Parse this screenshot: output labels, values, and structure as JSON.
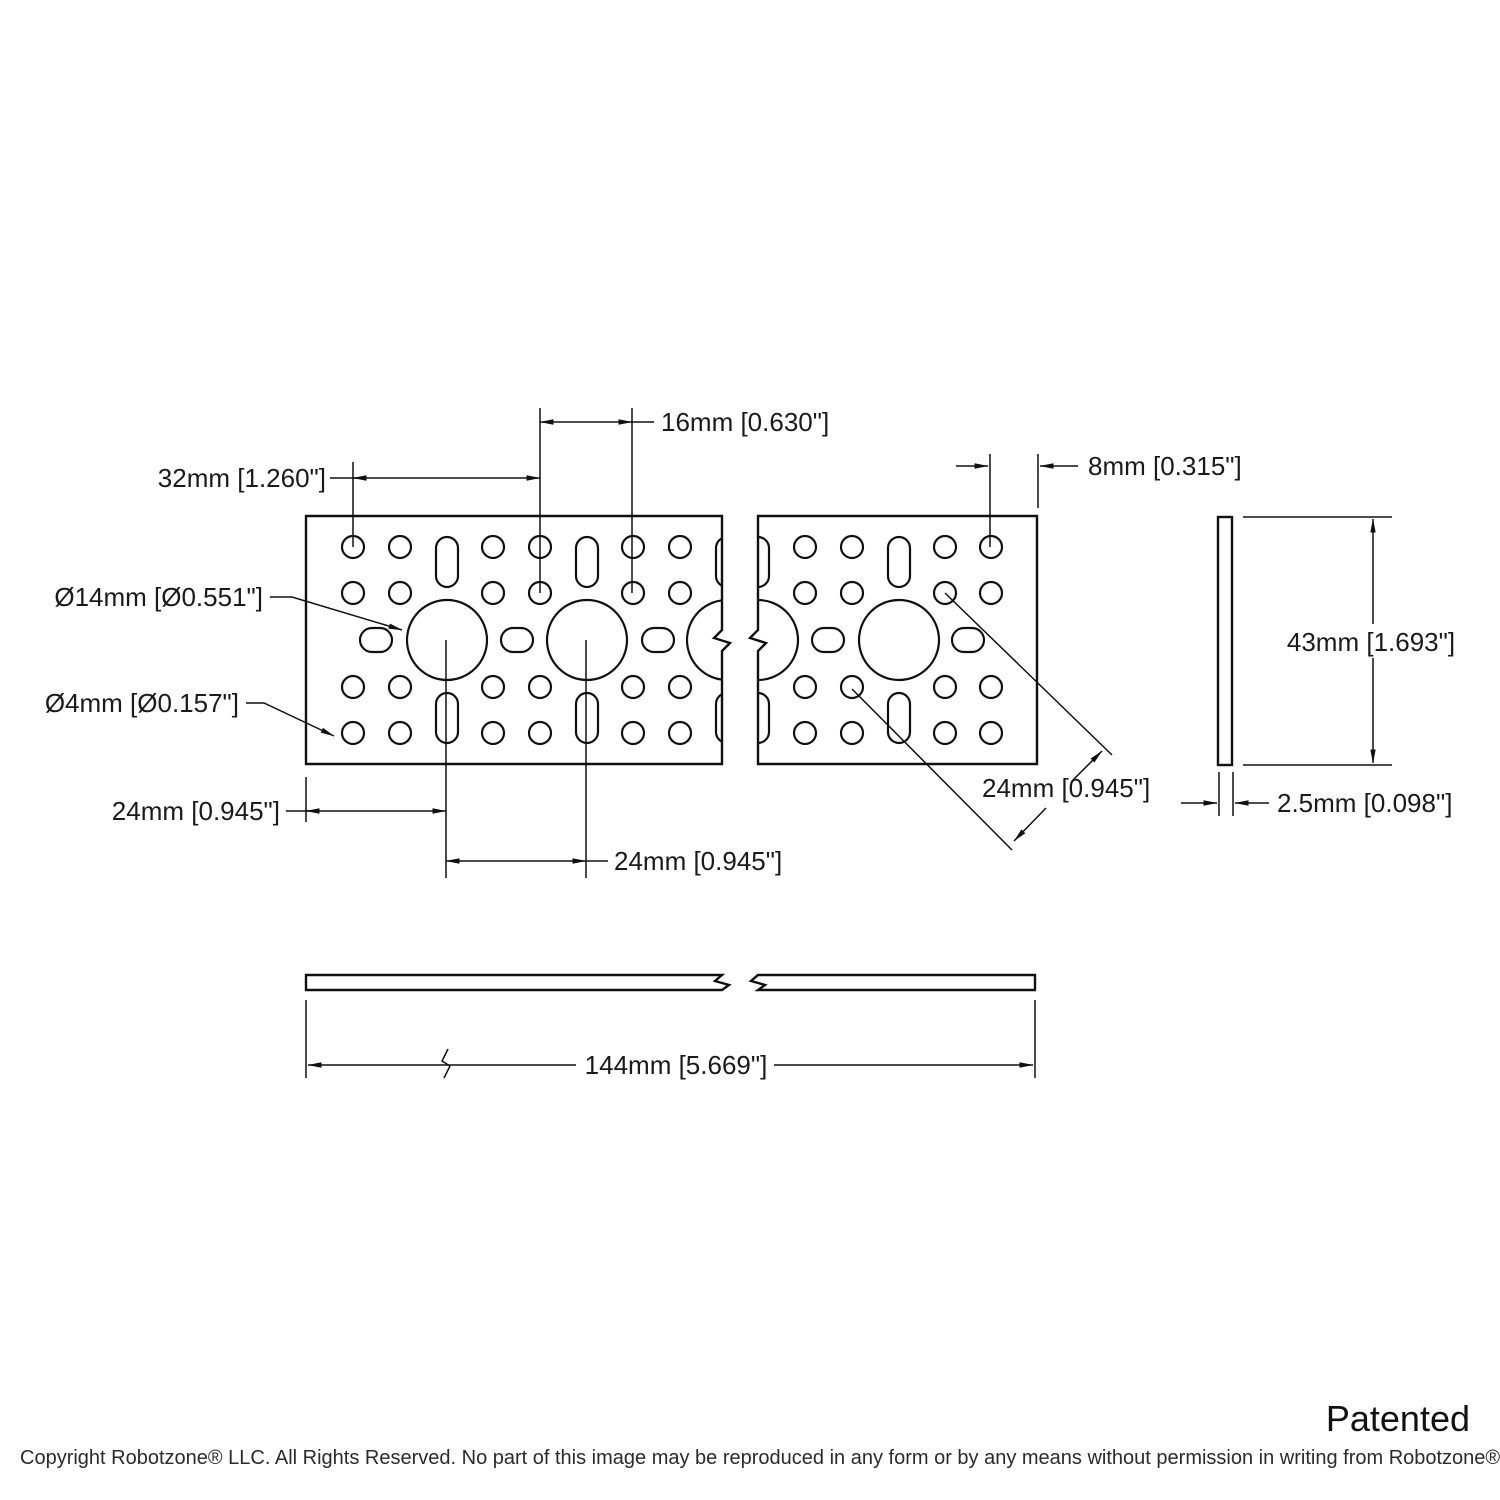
{
  "page": {
    "background": "#ffffff",
    "line_color": "#101010",
    "text_color": "#1a1a1a"
  },
  "dimensions": {
    "hole_spacing_16mm": "16mm [0.630\"]",
    "hole_spacing_32mm": "32mm [1.260\"]",
    "edge_offset_8mm": "8mm [0.315\"]",
    "large_hole_diameter": "Ø14mm [Ø0.551\"]",
    "small_hole_diameter": "Ø4mm [Ø0.157\"]",
    "plate_height_43mm": "43mm [1.693\"]",
    "edge_to_center_24mm": "24mm [0.945\"]",
    "center_to_center_24mm": "24mm [0.945\"]",
    "diagonal_spacing_24mm": "24mm [0.945\"]",
    "thickness_2_5mm": "2.5mm [0.098\"]",
    "overall_length_144mm": "144mm [5.669\"]"
  },
  "footer": {
    "patent_note": "Patented",
    "copyright": "Copyright Robotzone® LLC.  All Rights Reserved. No part of this image may be reproduced in any form or by any means without permission in writing from Robotzone® LLC."
  }
}
